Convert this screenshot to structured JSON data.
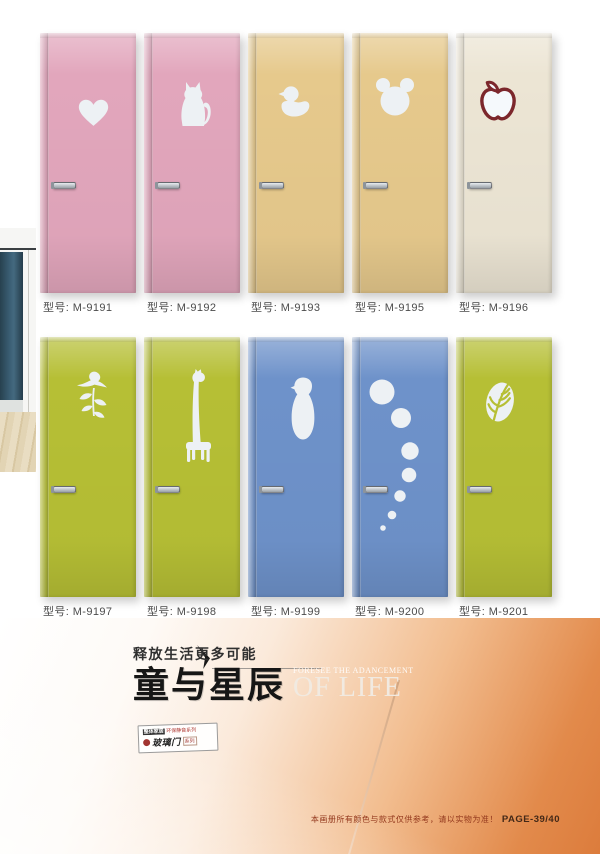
{
  "doors": [
    {
      "label": "型号: M-9191",
      "design": "heart",
      "color": "#e2a6bc"
    },
    {
      "label": "型号: M-9192",
      "design": "cat",
      "color": "#e2a6bc"
    },
    {
      "label": "型号: M-9193",
      "design": "duck",
      "color": "#e6c98c"
    },
    {
      "label": "型号: M-9195",
      "design": "mickey",
      "color": "#e6c98c"
    },
    {
      "label": "型号: M-9196",
      "design": "apple",
      "color": "#ece5d4"
    },
    {
      "label": "型号: M-9197",
      "design": "bird-branch",
      "color": "#b6bf35"
    },
    {
      "label": "型号: M-9198",
      "design": "giraffe",
      "color": "#b6bf35"
    },
    {
      "label": "型号: M-9199",
      "design": "penguin",
      "color": "#6e92ca"
    },
    {
      "label": "型号: M-9200",
      "design": "bubbles",
      "color": "#6e92ca"
    },
    {
      "label": "型号: M-9201",
      "design": "leaf",
      "color": "#b6bf35"
    }
  ],
  "hero": {
    "tagline": "释放生活更多可能",
    "title": "童与星辰",
    "subtitle_small": "FORESEE THE ADANCEMENT",
    "subtitle_large": "OF LIFE",
    "logo_tagline_dark": "整体家居",
    "logo_tagline_red": "环保静音系列",
    "logo_series": "玻璃门",
    "logo_series_suffix": "系列"
  },
  "footer": {
    "disclaimer": "本画册所有颜色与款式仅供参考，请以实物为准！",
    "page": "PAGE-39/40"
  },
  "colors": {
    "cutout": "#edf1f4",
    "apple_outline": "#7c272c",
    "hero_orange": "#dc7c3c"
  }
}
